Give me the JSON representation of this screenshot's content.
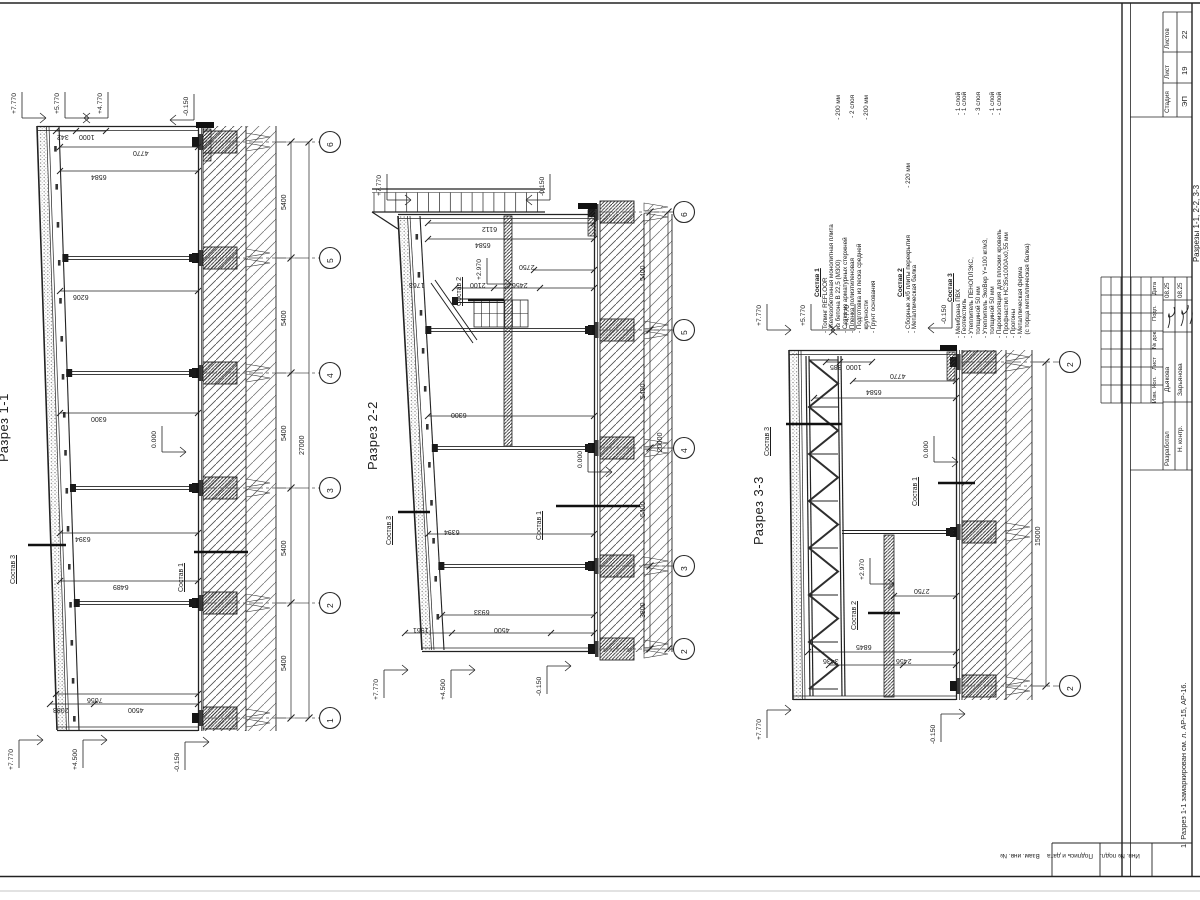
{
  "sections": [
    {
      "title": "Разрез 1-1"
    },
    {
      "title": "Разрез 2-2"
    },
    {
      "title": "Разрез 3-3"
    }
  ],
  "note": "1. Разрез 1-1 замаркирован см. л. АР-15, АР-16.",
  "compositions": [
    {
      "title": "Состав 1",
      "items": [
        {
          "text": "- Топинг REFLOOR",
          "value": ""
        },
        {
          "text": "- Железобетонная монолитная плита",
          "value": ""
        },
        {
          "text": "  из бетона В 22,5 (М300)",
          "value": "- 200 мм"
        },
        {
          "text": "- Сетка из арматурных стержней",
          "value": ""
        },
        {
          "text": "- Пленка полиэтиленовая",
          "value": "- 2 слоя"
        },
        {
          "text": "- Подготовка из песка средней",
          "value": ""
        },
        {
          "text": "  крупности",
          "value": "- 200 мм"
        },
        {
          "text": "- Грунт основания",
          "value": ""
        }
      ]
    },
    {
      "title": "Состав 2",
      "items": [
        {
          "text": "- Сборные ж/б плиты перекрытия",
          "value": "- 220 мм"
        },
        {
          "text": "- Металлическая балка",
          "value": ""
        }
      ]
    },
    {
      "title": "Состав 3",
      "items": [
        {
          "text": "- Мембрана ПВХ",
          "value": "- 1 слой"
        },
        {
          "text": "- Геотекстиль",
          "value": "- 1 слой"
        },
        {
          "text": "- Утеплитель ПЕНОПЛЭКС,",
          "value": ""
        },
        {
          "text": "  толщиной 50 мм",
          "value": "- 3 слоя"
        },
        {
          "text": "- Утеплитель ЭкоВер Y=100 кг/м3,",
          "value": ""
        },
        {
          "text": "  толщиной 50 мм",
          "value": "- 1 слой"
        },
        {
          "text": "- Пароизоляция для плоских кровель",
          "value": "- 1 слой"
        },
        {
          "text": "- Профнастил НС35х1000Ах0,55 мм",
          "value": ""
        },
        {
          "text": "- Прогоны",
          "value": ""
        },
        {
          "text": "- Металлическая ферма",
          "value": ""
        },
        {
          "text": "  (с торца металлическая балка)",
          "value": ""
        }
      ]
    }
  ],
  "titleblock": {
    "stadia_label": "Стадия",
    "list_label": "Лист",
    "listov_label": "Листов",
    "stadia": "ЭП",
    "list": "19",
    "listov": "22",
    "doc_name": "Разрезы 1-1, 2-2, 3-3",
    "rev_headers": [
      "Дата",
      "Подп.",
      "№ док.",
      "Лист",
      "Кол.",
      "Изм."
    ],
    "rows": [
      {
        "role": "Разработал",
        "name": "Дьякова",
        "date": "08.25"
      },
      {
        "role": "Н. контр.",
        "name": "Зарьянова",
        "date": "08.25"
      }
    ],
    "margin_fields": [
      "Взам. инв. №",
      "Подпись и дата",
      "Инв. № подл."
    ]
  },
  "axes": [
    {
      "x": 330,
      "y": 142,
      "n": "6"
    },
    {
      "x": 330,
      "y": 258,
      "n": "5"
    },
    {
      "x": 330,
      "y": 373,
      "n": "4"
    },
    {
      "x": 330,
      "y": 488,
      "n": "3"
    },
    {
      "x": 330,
      "y": 603,
      "n": "2"
    },
    {
      "x": 330,
      "y": 718,
      "n": "1"
    },
    {
      "x": 684,
      "y": 212,
      "n": "6"
    },
    {
      "x": 684,
      "y": 330,
      "n": "5"
    },
    {
      "x": 684,
      "y": 448,
      "n": "4"
    },
    {
      "x": 684,
      "y": 566,
      "n": "3"
    },
    {
      "x": 684,
      "y": 649,
      "n": "2"
    },
    {
      "x": 1070,
      "y": 362,
      "n": "2"
    },
    {
      "x": 1070,
      "y": 686,
      "n": "2"
    }
  ],
  "labels": [
    {
      "t": "342",
      "x": 57,
      "y": 133,
      "k": "dim"
    },
    {
      "t": "1000",
      "x": 79,
      "y": 133,
      "k": "dim"
    },
    {
      "t": "4770",
      "x": 133,
      "y": 149,
      "k": "dim"
    },
    {
      "t": "6584",
      "x": 91,
      "y": 173,
      "k": "dim"
    },
    {
      "t": "6206",
      "x": 73,
      "y": 293,
      "k": "dim"
    },
    {
      "t": "6300",
      "x": 91,
      "y": 415,
      "k": "dim"
    },
    {
      "t": "6394",
      "x": 75,
      "y": 535,
      "k": "dim"
    },
    {
      "t": "6489",
      "x": 113,
      "y": 583,
      "k": "dim"
    },
    {
      "t": "7056",
      "x": 87,
      "y": 696,
      "k": "dim"
    },
    {
      "t": "2083",
      "x": 53,
      "y": 706,
      "k": "dim"
    },
    {
      "t": "4500",
      "x": 128,
      "y": 706,
      "k": "dim"
    },
    {
      "t": "6112",
      "x": 482,
      "y": 225,
      "k": "dim"
    },
    {
      "t": "6584",
      "x": 475,
      "y": 241,
      "k": "dim"
    },
    {
      "t": "2750",
      "x": 519,
      "y": 263,
      "k": "dim"
    },
    {
      "t": "2456",
      "x": 512,
      "y": 281,
      "k": "dim"
    },
    {
      "t": "2100",
      "x": 470,
      "y": 281,
      "k": "dim"
    },
    {
      "t": "1763",
      "x": 409,
      "y": 281,
      "k": "dim"
    },
    {
      "t": "6300",
      "x": 451,
      "y": 411,
      "k": "dim"
    },
    {
      "t": "6394",
      "x": 444,
      "y": 528,
      "k": "dim"
    },
    {
      "t": "6933",
      "x": 474,
      "y": 608,
      "k": "dim"
    },
    {
      "t": "1961",
      "x": 413,
      "y": 626,
      "k": "dim"
    },
    {
      "t": "4500",
      "x": 494,
      "y": 626,
      "k": "dim"
    },
    {
      "t": "385",
      "x": 830,
      "y": 363,
      "k": "dim"
    },
    {
      "t": "1000",
      "x": 846,
      "y": 363,
      "k": "dim"
    },
    {
      "t": "4770",
      "x": 890,
      "y": 372,
      "k": "dim"
    },
    {
      "t": "6584",
      "x": 866,
      "y": 388,
      "k": "dim"
    },
    {
      "t": "2750",
      "x": 914,
      "y": 587,
      "k": "dim"
    },
    {
      "t": "2456",
      "x": 896,
      "y": 657,
      "k": "dim"
    },
    {
      "t": "3436",
      "x": 823,
      "y": 657,
      "k": "dim"
    },
    {
      "t": "6845",
      "x": 856,
      "y": 643,
      "k": "dim"
    },
    {
      "t": "5400",
      "x": 281,
      "y": 210,
      "k": "chain"
    },
    {
      "t": "5400",
      "x": 281,
      "y": 326,
      "k": "chain"
    },
    {
      "t": "5400",
      "x": 281,
      "y": 441,
      "k": "chain"
    },
    {
      "t": "5400",
      "x": 281,
      "y": 556,
      "k": "chain"
    },
    {
      "t": "5400",
      "x": 281,
      "y": 671,
      "k": "chain"
    },
    {
      "t": "27000",
      "x": 299,
      "y": 455,
      "k": "chain"
    },
    {
      "t": "5400",
      "x": 640,
      "y": 281,
      "k": "chain"
    },
    {
      "t": "5400",
      "x": 640,
      "y": 399,
      "k": "chain"
    },
    {
      "t": "5400",
      "x": 640,
      "y": 517,
      "k": "chain"
    },
    {
      "t": "3800",
      "x": 640,
      "y": 618,
      "k": "chain"
    },
    {
      "t": "20000",
      "x": 657,
      "y": 452,
      "k": "chain"
    },
    {
      "t": "15000",
      "x": 1035,
      "y": 546,
      "k": "chain"
    },
    {
      "t": "+7.770",
      "x": 12,
      "y": 114,
      "k": "mark",
      "d": 1,
      "v": 1
    },
    {
      "t": "+5.770",
      "x": 55,
      "y": 114,
      "k": "mark",
      "d": 1,
      "v": 1
    },
    {
      "t": "+4.770",
      "x": 98,
      "y": 114,
      "k": "mark",
      "d": -1,
      "v": 1
    },
    {
      "t": "-0.150",
      "x": 184,
      "y": 116,
      "k": "mark",
      "d": -1,
      "v": 1
    },
    {
      "t": "0.000",
      "x": 152,
      "y": 448,
      "k": "mark",
      "d": 1,
      "v": 1
    },
    {
      "t": "+7.770",
      "x": 9,
      "y": 770,
      "k": "mark",
      "d": 1,
      "v": -1
    },
    {
      "t": "+4.500",
      "x": 73,
      "y": 770,
      "k": "mark",
      "d": 1,
      "v": -1
    },
    {
      "t": "-0.150",
      "x": 175,
      "y": 772,
      "k": "mark",
      "d": 1,
      "v": -1
    },
    {
      "t": "+7.770",
      "x": 377,
      "y": 196,
      "k": "mark",
      "d": 1,
      "v": 1
    },
    {
      "t": "-0.150",
      "x": 540,
      "y": 196,
      "k": "mark",
      "d": -1,
      "v": 1
    },
    {
      "t": "+2.970",
      "x": 477,
      "y": 280,
      "k": "mark",
      "d": 1,
      "v": 1
    },
    {
      "t": "0.000",
      "x": 578,
      "y": 468,
      "k": "mark",
      "d": 1,
      "v": 1
    },
    {
      "t": "+7.770",
      "x": 374,
      "y": 700,
      "k": "mark",
      "d": 1,
      "v": -1
    },
    {
      "t": "+4.500",
      "x": 441,
      "y": 700,
      "k": "mark",
      "d": 1,
      "v": -1
    },
    {
      "t": "-0.150",
      "x": 537,
      "y": 696,
      "k": "mark",
      "d": 1,
      "v": -1
    },
    {
      "t": "+7.770",
      "x": 757,
      "y": 326,
      "k": "mark",
      "d": 1,
      "v": 1
    },
    {
      "t": "+5.770",
      "x": 801,
      "y": 326,
      "k": "mark",
      "d": 1,
      "v": 1
    },
    {
      "t": "+4.770",
      "x": 845,
      "y": 326,
      "k": "mark",
      "d": -1,
      "v": 1
    },
    {
      "t": "-0.150",
      "x": 942,
      "y": 324,
      "k": "mark",
      "d": -1,
      "v": 1
    },
    {
      "t": "0.000",
      "x": 924,
      "y": 458,
      "k": "mark",
      "d": 1,
      "v": 1
    },
    {
      "t": "+2.970",
      "x": 860,
      "y": 580,
      "k": "mark",
      "d": 1,
      "v": 1
    },
    {
      "t": "+7.770",
      "x": 757,
      "y": 740,
      "k": "mark",
      "d": 1,
      "v": -1
    },
    {
      "t": "-0.150",
      "x": 931,
      "y": 744,
      "k": "mark",
      "d": 1,
      "v": -1
    },
    {
      "t": "Состав 3",
      "x": 10,
      "y": 584,
      "k": "comp"
    },
    {
      "t": "Состав 1",
      "x": 178,
      "y": 592,
      "k": "comp"
    },
    {
      "t": "Состав 3",
      "x": 386,
      "y": 545,
      "k": "comp"
    },
    {
      "t": "Состав 1",
      "x": 536,
      "y": 540,
      "k": "comp"
    },
    {
      "t": "Состав 2",
      "x": 456,
      "y": 306,
      "k": "comp"
    },
    {
      "t": "Состав 3",
      "x": 764,
      "y": 456,
      "k": "comp"
    },
    {
      "t": "Состав 1",
      "x": 912,
      "y": 506,
      "k": "comp"
    },
    {
      "t": "Состав 2",
      "x": 851,
      "y": 630,
      "k": "comp"
    },
    {
      "t": "Разрез 1-1",
      "x": -3,
      "y": 462,
      "k": "title"
    },
    {
      "t": "Разрез 2-2",
      "x": 366,
      "y": 470,
      "k": "title"
    },
    {
      "t": "Разрез 3-3",
      "x": 752,
      "y": 545,
      "k": "title"
    }
  ]
}
